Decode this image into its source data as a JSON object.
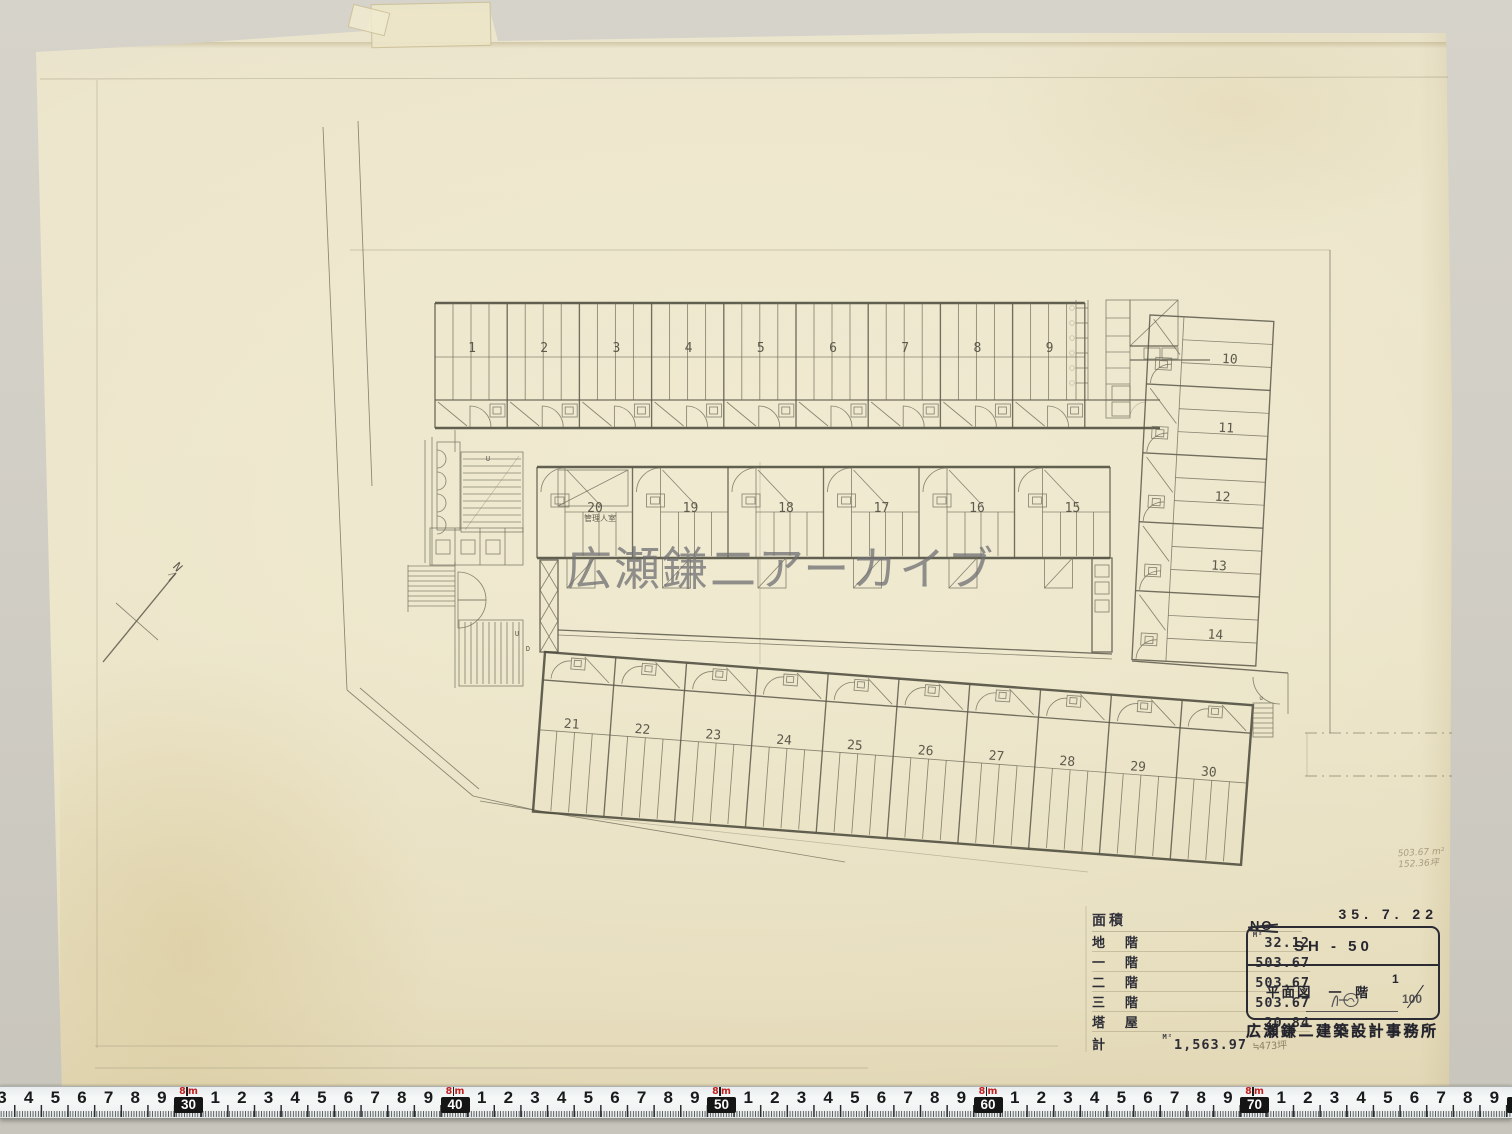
{
  "watermark": {
    "text": "広瀬鎌二アーカイブ"
  },
  "north_arrow": {
    "label": "N"
  },
  "plan": {
    "rooms_top": [
      "1",
      "2",
      "3",
      "4",
      "5",
      "6",
      "7",
      "8",
      "9"
    ],
    "rooms_right": [
      "10",
      "11",
      "12",
      "13",
      "14"
    ],
    "rooms_middle": [
      "20",
      "19",
      "18",
      "17",
      "16",
      "15"
    ],
    "rooms_bottom": [
      "21",
      "22",
      "23",
      "24",
      "25",
      "26",
      "27",
      "28",
      "29",
      "30"
    ],
    "caretaker_room_label": "管理人室",
    "stair_up_label": "U",
    "stair_down_label": "D",
    "stair_small_label": "u"
  },
  "handwritten_note": {
    "line1": "503.67 m²",
    "line2": "152.36坪"
  },
  "area_table": {
    "title": "面積",
    "unit_sup": "M²",
    "rows": [
      {
        "label": "地 階",
        "value": "32.12",
        "sup": true
      },
      {
        "label": "一 階",
        "value": "503.67",
        "sup": false
      },
      {
        "label": "二 階",
        "value": "503.67",
        "sup": false
      },
      {
        "label": "三 階",
        "value": "503.67",
        "sup": false
      },
      {
        "label": "塔 屋",
        "value": "20.84",
        "sup": false
      }
    ],
    "total_label": "計",
    "total_value": "1,563.97",
    "total_note": "≒473坪"
  },
  "title_block": {
    "no_label": "NO",
    "date": "35. 7. 22",
    "drawing_code": "SH - 50",
    "drawing_type": "平面図",
    "floor_label": "一 階",
    "scale_numerator": "1",
    "scale_denominator": "100",
    "office_name": "広瀬鎌二建築設計事務所"
  },
  "ruler": {
    "meter_digit": "8",
    "meter_unit": "m",
    "cells": [
      "3",
      "4",
      "5",
      "6",
      "7",
      "8",
      "9",
      "#30",
      "1",
      "2",
      "3",
      "4",
      "5",
      "6",
      "7",
      "8",
      "9",
      "#40",
      "1",
      "2",
      "3",
      "4",
      "5",
      "6",
      "7",
      "8",
      "9",
      "#50",
      "1",
      "2",
      "3",
      "4",
      "5",
      "6",
      "7",
      "8",
      "9",
      "#60",
      "1",
      "2",
      "3",
      "4",
      "5",
      "6",
      "7",
      "8",
      "9",
      "#70",
      "1",
      "2",
      "3",
      "4",
      "5",
      "6",
      "7",
      "8",
      "9",
      "#80"
    ]
  },
  "colors": {
    "paper": "#ebe4c9",
    "background": "#d2cfc6",
    "pencil": "#5f5d50",
    "stamp_ink": "#26262f",
    "ruler_red": "#c32120",
    "watermark_gray": "#71716f"
  }
}
